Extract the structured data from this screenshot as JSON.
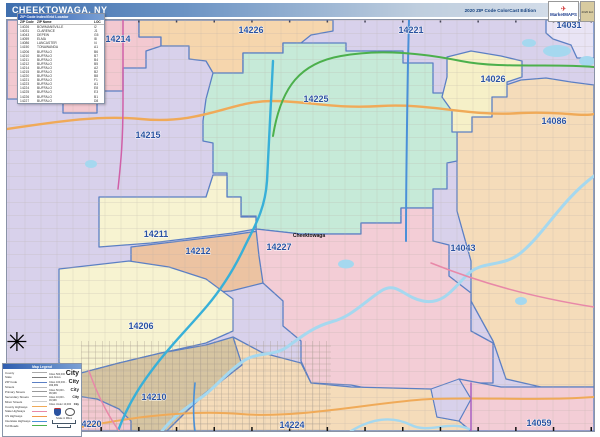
{
  "header": {
    "title": "CHEEKTOWAGA, NY",
    "edition": "2020 ZIP Code ColorCast Edition",
    "logo": {
      "brand": "MarketMAPS",
      "mark_icon": "✈",
      "tag": "2020 Ed."
    }
  },
  "zip_index": {
    "title": "ZIP Code Index/Grid Locator",
    "columns": [
      "ZIP Code",
      "ZIP Name",
      "LOC"
    ],
    "rows": [
      {
        "zip": "14026",
        "name": "BOWMANSVILLE",
        "loc": "I2"
      },
      {
        "zip": "14031",
        "name": "CLARENCE",
        "loc": "J1"
      },
      {
        "zip": "14043",
        "name": "DEPEW",
        "loc": "G5"
      },
      {
        "zip": "14059",
        "name": "ELMA",
        "loc": "I8"
      },
      {
        "zip": "14086",
        "name": "LANCASTER",
        "loc": "I4"
      },
      {
        "zip": "14150",
        "name": "TONAWANDA",
        "loc": "A1"
      },
      {
        "zip": "14206",
        "name": "BUFFALO",
        "loc": "B6"
      },
      {
        "zip": "14210",
        "name": "BUFFALO",
        "loc": "B7"
      },
      {
        "zip": "14211",
        "name": "BUFFALO",
        "loc": "B4"
      },
      {
        "zip": "14212",
        "name": "BUFFALO",
        "loc": "B5"
      },
      {
        "zip": "14214",
        "name": "BUFFALO",
        "loc": "A2"
      },
      {
        "zip": "14215",
        "name": "BUFFALO",
        "loc": "B2"
      },
      {
        "zip": "14220",
        "name": "BUFFALO",
        "loc": "B8"
      },
      {
        "zip": "14221",
        "name": "BUFFALO",
        "loc": "F1"
      },
      {
        "zip": "14223",
        "name": "BUFFALO",
        "loc": "A1"
      },
      {
        "zip": "14224",
        "name": "BUFFALO",
        "loc": "E8"
      },
      {
        "zip": "14225",
        "name": "BUFFALO",
        "loc": "E3"
      },
      {
        "zip": "14226",
        "name": "BUFFALO",
        "loc": "B1"
      },
      {
        "zip": "14227",
        "name": "BUFFALO",
        "loc": "D8"
      }
    ]
  },
  "map": {
    "city_label": "Cheektowaga",
    "compass_glyph": "✳",
    "zip_labels": [
      {
        "text": "14214"
      },
      {
        "text": "14226"
      },
      {
        "text": "14221"
      },
      {
        "text": "14031"
      },
      {
        "text": "14026"
      },
      {
        "text": "14086"
      },
      {
        "text": "14225"
      },
      {
        "text": "14215"
      },
      {
        "text": "14211"
      },
      {
        "text": "14212"
      },
      {
        "text": "14227"
      },
      {
        "text": "14043"
      },
      {
        "text": "14206"
      },
      {
        "text": "14210"
      },
      {
        "text": "14220"
      },
      {
        "text": "14224"
      },
      {
        "text": "14059"
      }
    ]
  },
  "colors": {
    "lavender": "#d8d1eb",
    "corner": "#e9e4f5",
    "pink": "#f3c9d1",
    "orange": "#f6d6ad",
    "mint": "#c6ead8",
    "cream": "#f6f0c8",
    "peach": "#f5dcba",
    "salmon": "#ecc3a2",
    "paleYellow": "#f7f3d1",
    "pinkLight": "#f3cdd6",
    "tan": "#d6c5a2",
    "water": "#a5d8ef",
    "boundary": "#5b7fc4",
    "labelBlue": "#2a52a0",
    "roads": {
      "orange": "#f0aa58",
      "teal": "#38b0d8",
      "blue": "#4a90d8",
      "green": "#4cb04c",
      "magenta": "#d060a8",
      "pink": "#e888a8",
      "purple": "#a860c0"
    }
  },
  "legend": {
    "title": "Map Legend",
    "items": [
      {
        "label": "County"
      },
      {
        "label": "State"
      },
      {
        "label": "ZIP Code"
      },
      {
        "label": "Streets"
      },
      {
        "label": "Primary Streets"
      },
      {
        "label": "Secondary Streets"
      },
      {
        "label": "Minor Streets"
      },
      {
        "label": "County Highways"
      },
      {
        "label": "State Highways"
      },
      {
        "label": "US Highways"
      },
      {
        "label": "Interstate Highways"
      },
      {
        "label": "Toll Roads"
      }
    ],
    "cities": [
      {
        "label": "Cities 500,000 and Above",
        "sample": "City"
      },
      {
        "label": "Cities 100,000 - 499,999",
        "sample": "City"
      },
      {
        "label": "Cities 50,000 - 99,999",
        "sample": "City"
      },
      {
        "label": "Cities 10,000 - 49,999",
        "sample": "City"
      },
      {
        "label": "Cities Under 10,000",
        "sample": "City"
      }
    ],
    "scale_label": "Scale in Miles"
  }
}
